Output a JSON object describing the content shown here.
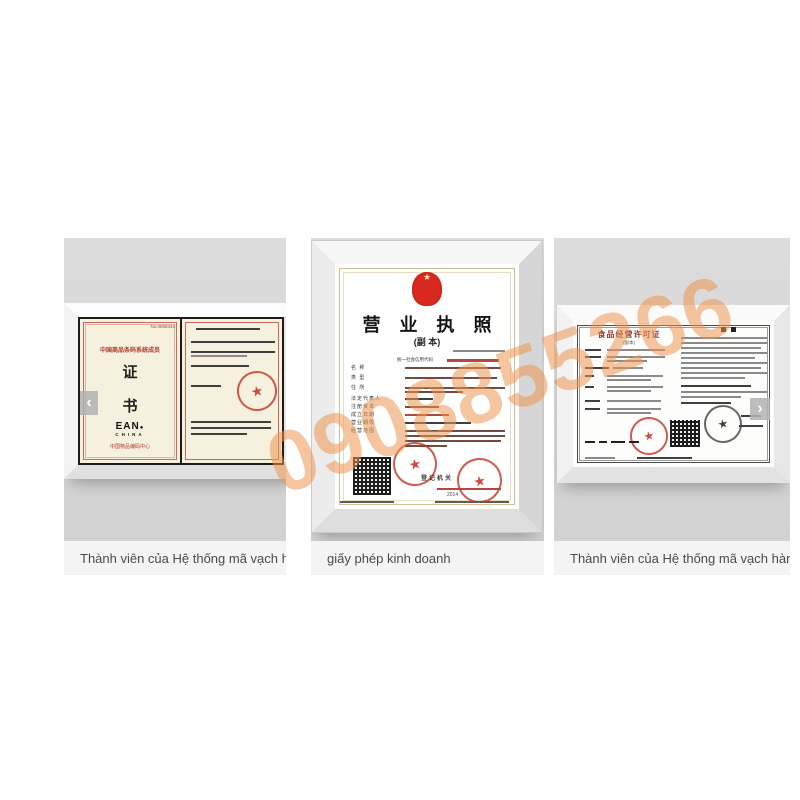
{
  "watermark": {
    "text": "0908855266",
    "color": "#ed9650"
  },
  "carousel": {
    "prev_icon": "‹",
    "next_icon": "›",
    "items": [
      {
        "caption": "Thành viên của Hệ thống mã vạch hàng h...",
        "certificate": {
          "serial": "No.0658443",
          "member_line": "中国商品条码系统成员",
          "seal_char_top": "证",
          "seal_char_bottom": "书",
          "logo": "EAN",
          "logo_dot": "●",
          "logo_sub": "CHINA",
          "org_line": "中国物品编码中心"
        }
      },
      {
        "caption": "giấy phép kinh doanh",
        "certificate": {
          "title": "营 业 执 照",
          "subtitle": "(副 本)",
          "credit_code_label": "统一社会信用代码",
          "field_labels": [
            "名 称",
            "类 型",
            "住 所",
            "法定代表人",
            "注册资本",
            "成立日期",
            "营业期限",
            "经营范围"
          ],
          "registrar_label": "登记机关",
          "year": "2014"
        }
      },
      {
        "caption": "Thành viên của Hệ thống mã vạch hàng h...",
        "certificate": {
          "title": "食品经营许可证",
          "subtitle": "(副本)"
        }
      }
    ]
  },
  "colors": {
    "stamp_red": "#c0392b",
    "panel_gray": "#d7d7d7",
    "caption_bg": "#f4f4f4"
  }
}
